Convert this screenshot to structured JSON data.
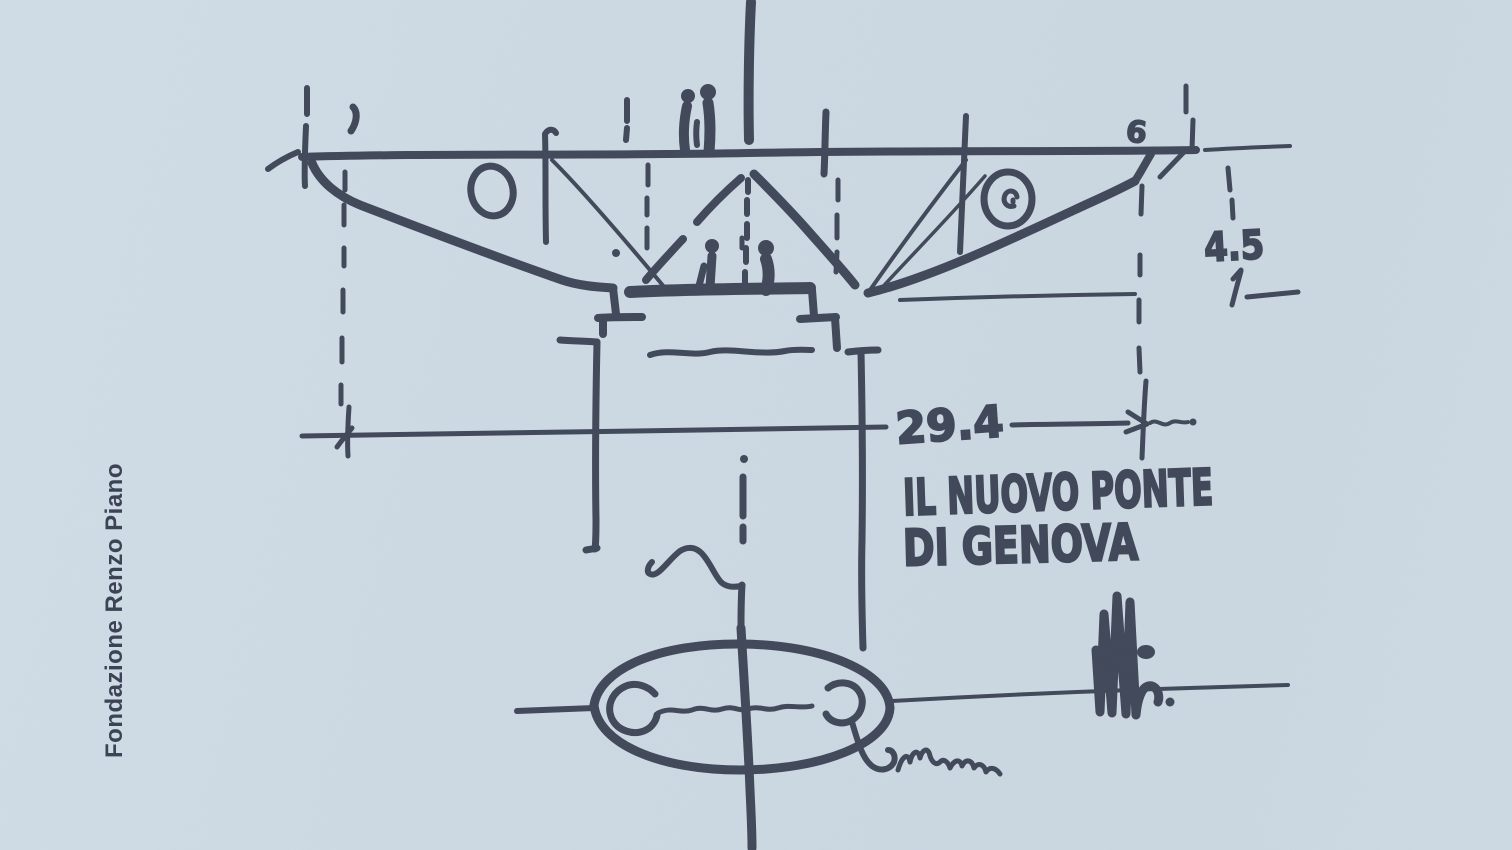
{
  "palette": {
    "paper_background": "#ccd8e2",
    "ink": "#404859",
    "credit_text_color": "#3c4355"
  },
  "credit": {
    "label": "Fondazione Renzo Piano"
  },
  "sketch": {
    "title": {
      "line1": "IL NUOVO PONTE",
      "line2": "DI GENOVA"
    },
    "dimensions": {
      "deck_width": "29.4",
      "deck_height_right": "4.5"
    },
    "marks": {
      "right_reference": "6"
    }
  }
}
